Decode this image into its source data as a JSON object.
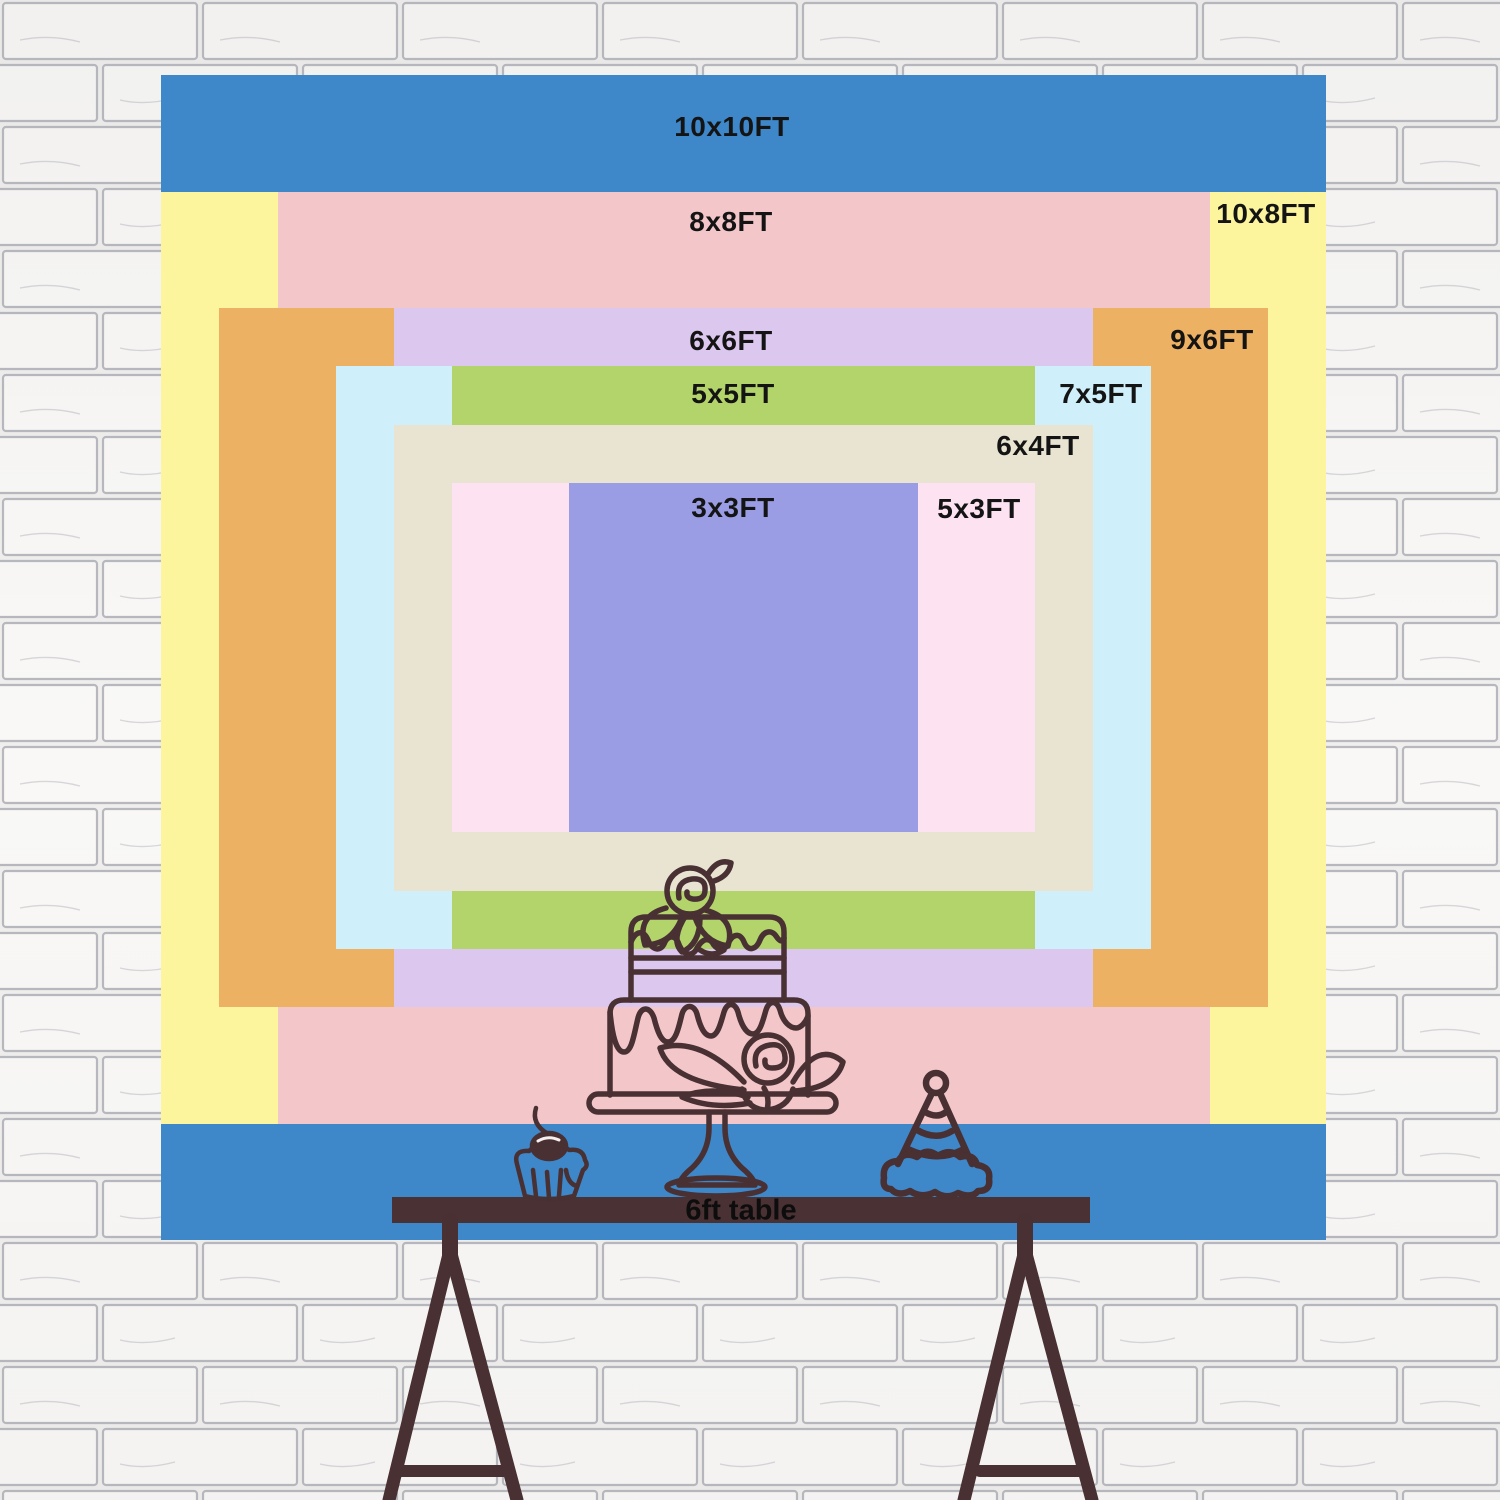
{
  "scene": {
    "width": 1500,
    "height": 1500
  },
  "wall": {
    "base_color": "#f2f1ef",
    "brick_fill": "#fbfaf8",
    "mortar_line_color": "#b8b8bf"
  },
  "backdrop": {
    "px_per_ft": 116.5,
    "center_x": 743.5,
    "center_y": 657.5,
    "label_color": "#141414",
    "sizes": [
      {
        "id": "10x10",
        "label": "10x10FT",
        "width_ft": 10,
        "height_ft": 10,
        "color": "#3e87c9",
        "label_x": 732,
        "label_y": 127
      },
      {
        "id": "10x8",
        "label": "10x8FT",
        "width_ft": 10,
        "height_ft": 8,
        "color": "#fdf59d",
        "label_x": 1266,
        "label_y": 214
      },
      {
        "id": "8x8",
        "label": "8x8FT",
        "width_ft": 8,
        "height_ft": 8,
        "color": "#f3c7c9",
        "label_x": 731,
        "label_y": 222
      },
      {
        "id": "9x6",
        "label": "9x6FT",
        "width_ft": 9,
        "height_ft": 6,
        "color": "#edb164",
        "label_x": 1212,
        "label_y": 340
      },
      {
        "id": "6x6",
        "label": "6x6FT",
        "width_ft": 6,
        "height_ft": 6,
        "color": "#dcc8ef",
        "label_x": 731,
        "label_y": 341
      },
      {
        "id": "7x5",
        "label": "7x5FT",
        "width_ft": 7,
        "height_ft": 5,
        "color": "#cfeffa",
        "label_x": 1101,
        "label_y": 394
      },
      {
        "id": "5x5",
        "label": "5x5FT",
        "width_ft": 5,
        "height_ft": 5,
        "color": "#b2d46a",
        "label_x": 733,
        "label_y": 394
      },
      {
        "id": "6x4",
        "label": "6x4FT",
        "width_ft": 6,
        "height_ft": 4,
        "color": "#e9e4d2",
        "label_x": 1038,
        "label_y": 446
      },
      {
        "id": "5x3",
        "label": "5x3FT",
        "width_ft": 5,
        "height_ft": 3,
        "color": "#fde3f2",
        "label_x": 979,
        "label_y": 509
      },
      {
        "id": "3x3",
        "label": "3x3FT",
        "width_ft": 3,
        "height_ft": 3,
        "color": "#9a9de4",
        "label_x": 733,
        "label_y": 508
      }
    ]
  },
  "table": {
    "label": "6ft table",
    "bar_color": "#4a3134",
    "label_x": 741,
    "label_y": 1211
  },
  "illustration": {
    "line_color": "#483033",
    "highlight_color": "#f6eff0",
    "items": [
      "tiered-cake",
      "cupcake-with-cherry",
      "party-hat",
      "trestle-table"
    ]
  }
}
